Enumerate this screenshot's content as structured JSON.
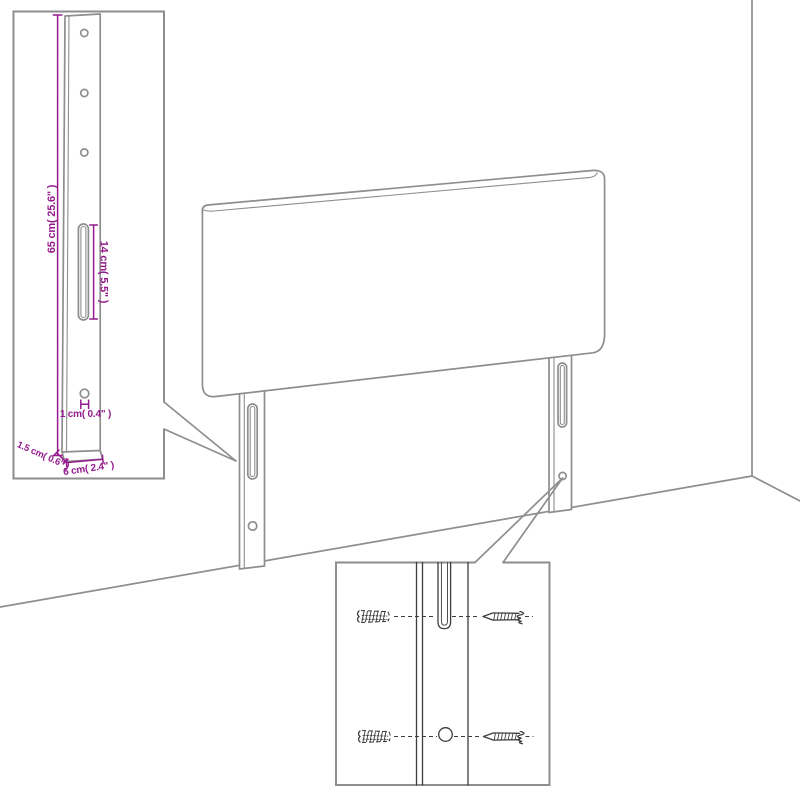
{
  "diagram": {
    "type": "furniture-dimension-diagram",
    "subject": "headboard with two wall-mount legs shown in a room corner",
    "colors": {
      "background": "#ffffff",
      "line": "#8e8e8e",
      "dark": "#3d3d3d",
      "dimension": "#941b8d"
    },
    "leg_detail_inset": {
      "description": "enlarged-mounting-leg-view",
      "height_label": "65 cm( 25.6\" )",
      "slot_label": "14 cm( 5.5\" )",
      "hole_label": "1 cm( 0.4\" )",
      "thickness_label": "1.5 cm( 0.6\" )",
      "width_label": "6 cm( 2.4\" )",
      "hole_count": 3
    },
    "mount_detail_inset": {
      "description": "slot-and-hole-close-up-with-screws-and-wall-plugs",
      "screw_count": 2,
      "wall_plug_count": 2
    }
  }
}
